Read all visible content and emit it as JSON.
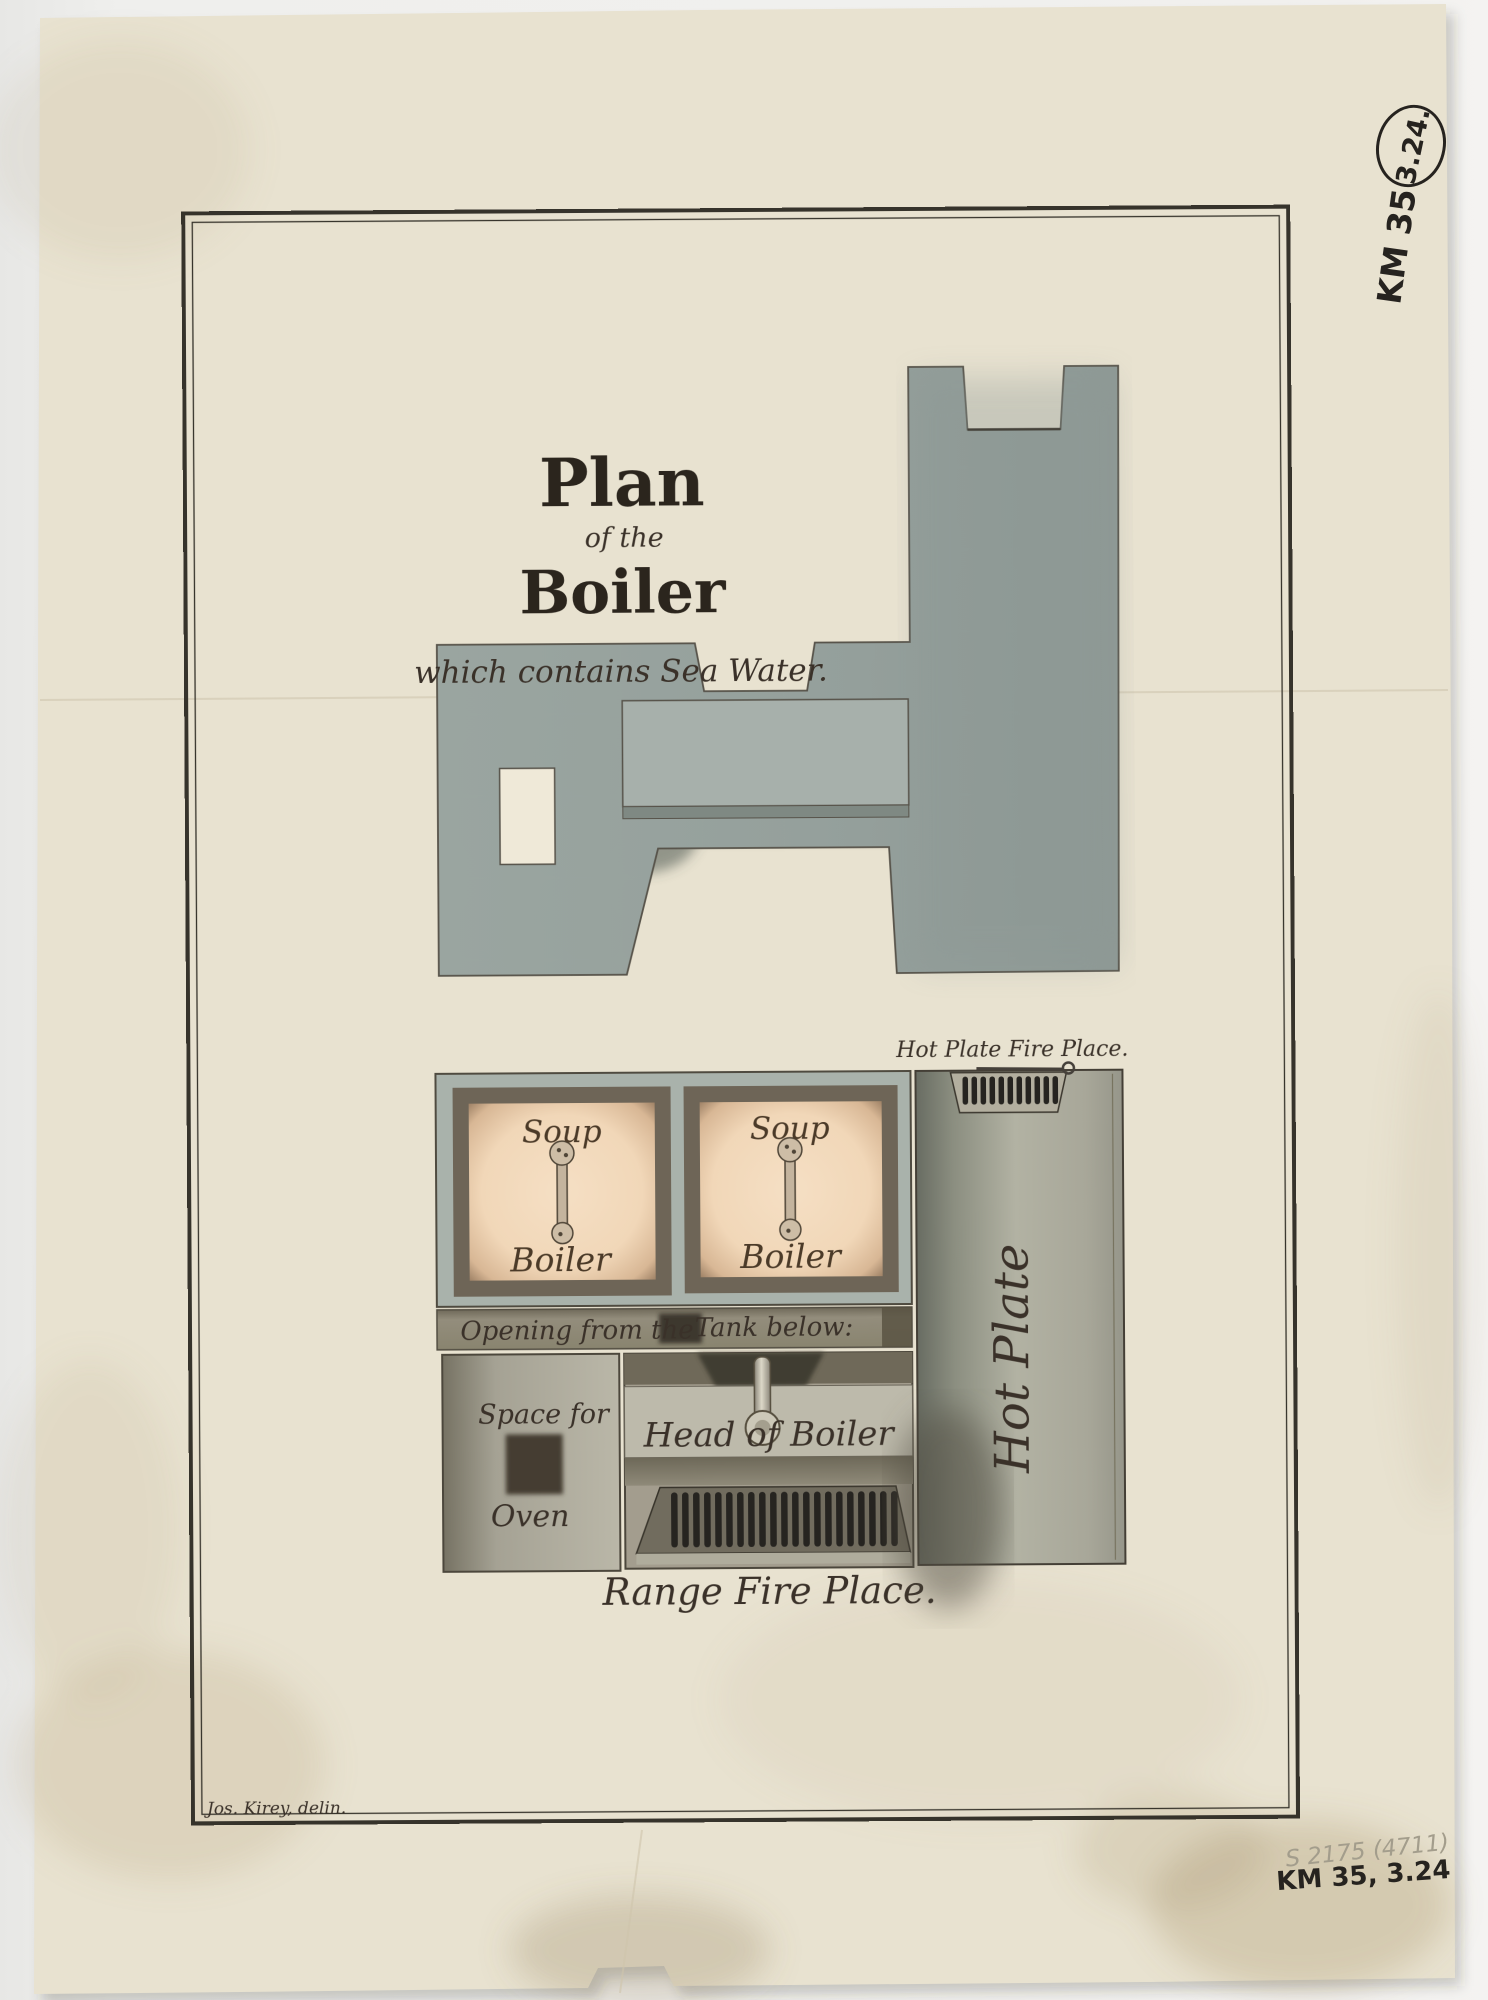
{
  "document": {
    "title_line1": "Plan",
    "title_line2": "of the",
    "title_line3": "Boiler",
    "subtitle": "which contains Sea Water.",
    "signature": "Jos. Kirey, delin."
  },
  "plan_labels": {
    "soup1_top": "Soup",
    "soup1_bottom": "Boiler",
    "soup2_top": "Soup",
    "soup2_bottom": "Boiler",
    "opening_left": "Opening from the",
    "opening_right": "Tank below:",
    "space_for": "Space for",
    "oven": "Oven",
    "head_of_boiler": "Head of Boiler",
    "range_fire_place": "Range Fire Place.",
    "hot_plate_fire_place": "Hot Plate Fire Place.",
    "hot_plate": "Hot Plate"
  },
  "annotations": {
    "circled_number": "3.24.",
    "shelf_mark": "KM 35",
    "pencil_note": "S 2175 (4711)",
    "ink_note": "KM 35, 3.24"
  },
  "colors": {
    "paper": "#e8e2d0",
    "wash_gray": "#9aa5a0",
    "bar_gray": "#a7b0ab",
    "frame_gray": "#a9b2ab",
    "peach": "#f3dcc0",
    "ink": "#2b251d",
    "grille_dark": "#262420"
  }
}
